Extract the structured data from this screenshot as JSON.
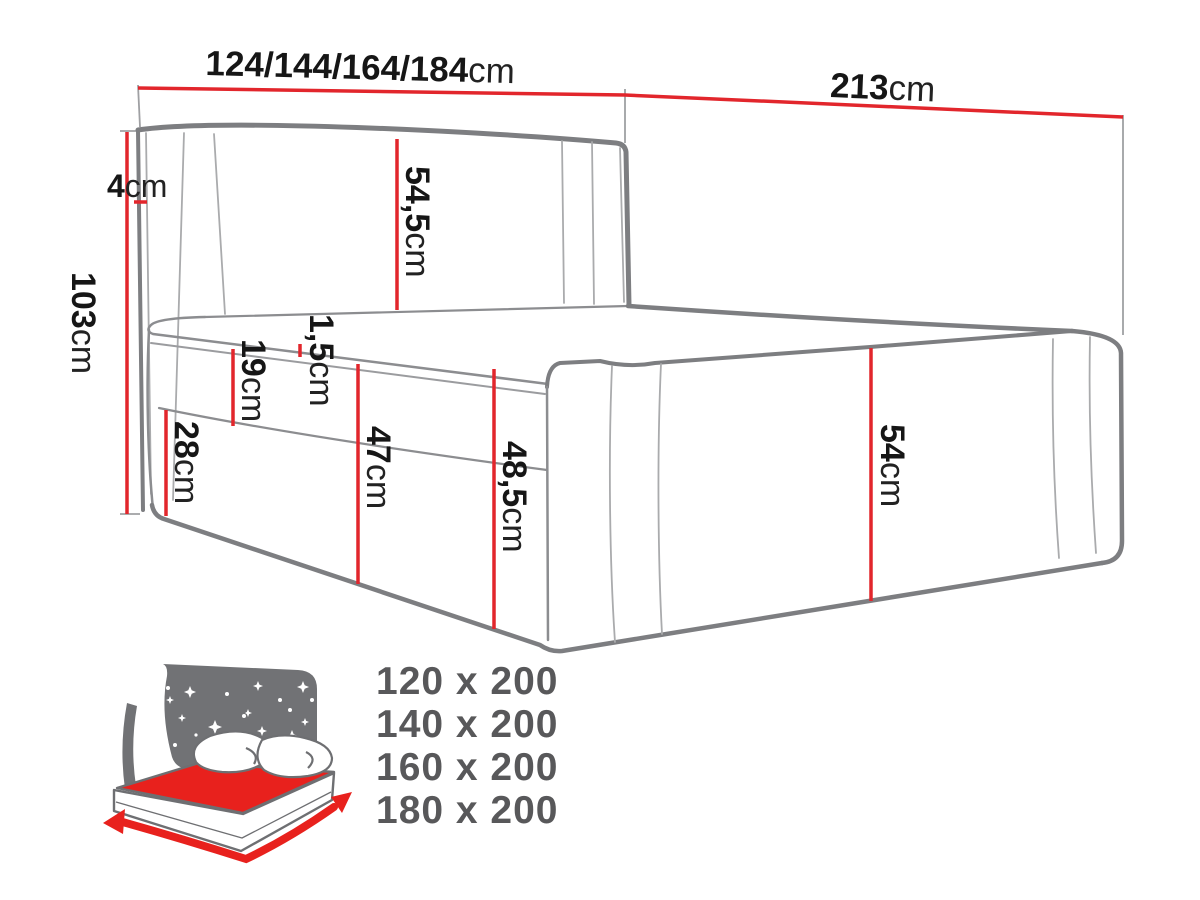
{
  "diagram": {
    "dimensions": {
      "width": {
        "value": "124/144/164/184",
        "unit": "cm"
      },
      "length": {
        "value": "213",
        "unit": "cm"
      },
      "total_height": {
        "value": "103",
        "unit": "cm"
      },
      "headboard_thickness": {
        "value": "4",
        "unit": "cm"
      },
      "headboard_height": {
        "value": "54,5",
        "unit": "cm"
      },
      "mattress_lip": {
        "value": "1,5",
        "unit": "cm"
      },
      "mattress_height": {
        "value": "19",
        "unit": "cm"
      },
      "base_height": {
        "value": "28",
        "unit": "cm"
      },
      "side_height": {
        "value": "47",
        "unit": "cm"
      },
      "side_total_height": {
        "value": "48,5",
        "unit": "cm"
      },
      "foot_height": {
        "value": "54",
        "unit": "cm"
      }
    },
    "available_sizes": {
      "items": [
        "120 x 200",
        "140 x 200",
        "160 x 200",
        "180 x 200"
      ]
    },
    "icons": [
      {
        "name": "storage-bed-night-icon"
      }
    ],
    "colors": {
      "dimension_red": "#e2262c",
      "outline_gray": "#7d7e81",
      "seam_gray": "#aaabad",
      "icon_gray": "#717275",
      "icon_red": "#e8211d",
      "sizes_text": "#58585a"
    }
  }
}
